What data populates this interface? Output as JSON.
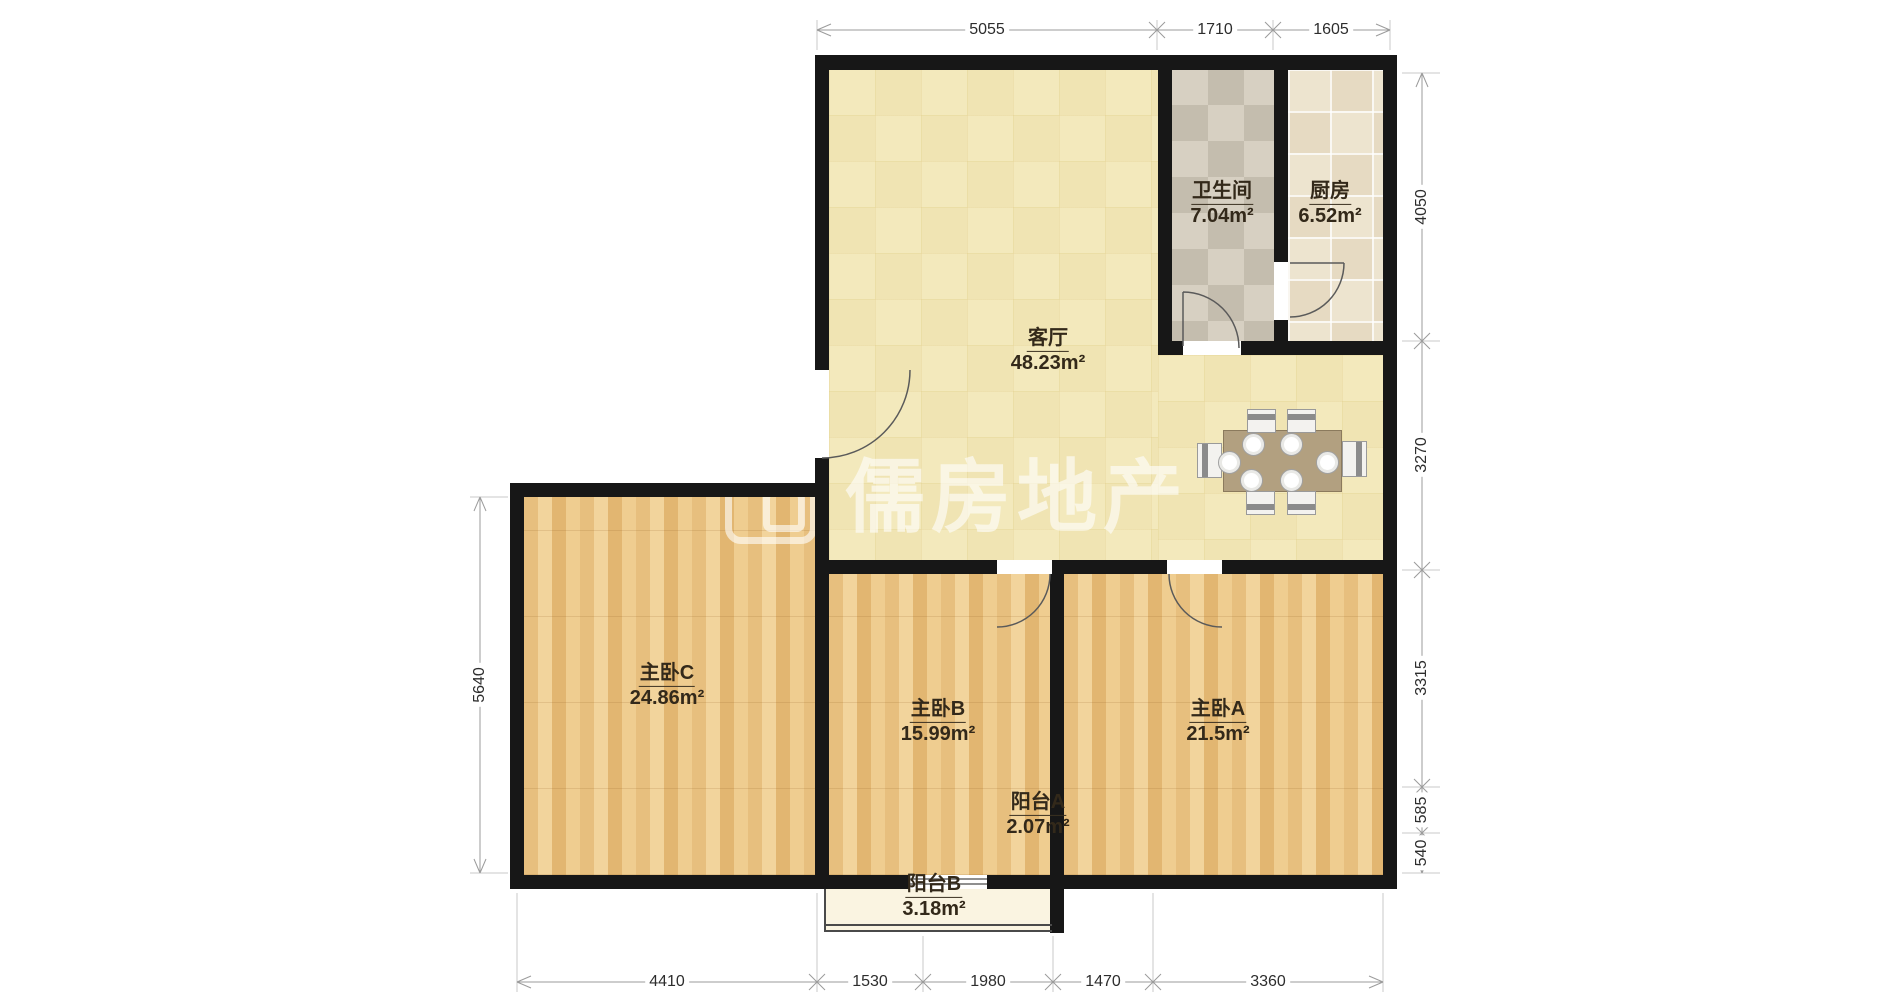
{
  "watermark": {
    "text": "儒房地产"
  },
  "rooms": [
    {
      "name": "客厅",
      "area": "48.23m²"
    },
    {
      "name": "卫生间",
      "area": "7.04m²"
    },
    {
      "name": "厨房",
      "area": "6.52m²"
    },
    {
      "name": "主卧C",
      "area": "24.86m²"
    },
    {
      "name": "主卧B",
      "area": "15.99m²"
    },
    {
      "name": "主卧A",
      "area": "21.5m²"
    },
    {
      "name": "阳台A",
      "area": "2.07m²"
    },
    {
      "name": "阳台B",
      "area": "3.18m²"
    }
  ],
  "dimensions_mm": {
    "top": [
      "5055",
      "1710",
      "1605"
    ],
    "right": [
      "4050",
      "3270",
      "3315",
      "585",
      "540"
    ],
    "bottom": [
      "4410",
      "1530",
      "1980",
      "1470",
      "3360"
    ],
    "left": [
      "5640"
    ]
  },
  "colors": {
    "wall": "#171717",
    "living_floor": "#f3e9bc",
    "wood_floor": "#ecc88c",
    "bath_tile": "#d7d0c2",
    "kitchen_tile": "#ede4cf",
    "balcony_floor": "#faf4e1",
    "dimension_text": "#2d2d2d",
    "watermark_color": "rgba(255,255,255,0.6)"
  }
}
